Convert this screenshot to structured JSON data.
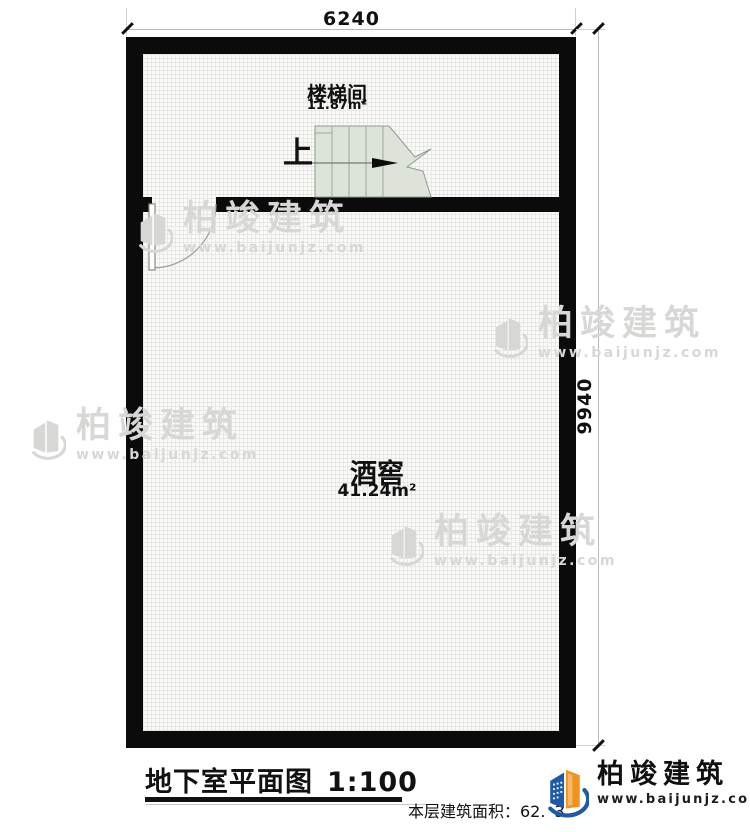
{
  "plan": {
    "dimensions": {
      "top": "6240",
      "right": "9940"
    },
    "rooms": [
      {
        "name": "楼梯间",
        "area": "11.87m²"
      },
      {
        "name": "酒窖",
        "area": "41.24m²"
      }
    ],
    "stair_direction_label": "上",
    "colors": {
      "wall": "#0b0b0b",
      "stair_fill": "#dde3d9",
      "floor": "#fafaf8"
    }
  },
  "footer": {
    "title": "地下室平面图",
    "scale": "1:100",
    "area_label": "本层建筑面积：62.",
    "area_obscured_digit": "3"
  },
  "brand": {
    "name": "柏竣建筑",
    "url": "www.baijunjz.com",
    "colors": {
      "blue": "#1f5aa8",
      "orange": "#f0941f"
    }
  },
  "watermark": {
    "name": "柏竣建筑",
    "url": "www.baijunjz.com"
  }
}
